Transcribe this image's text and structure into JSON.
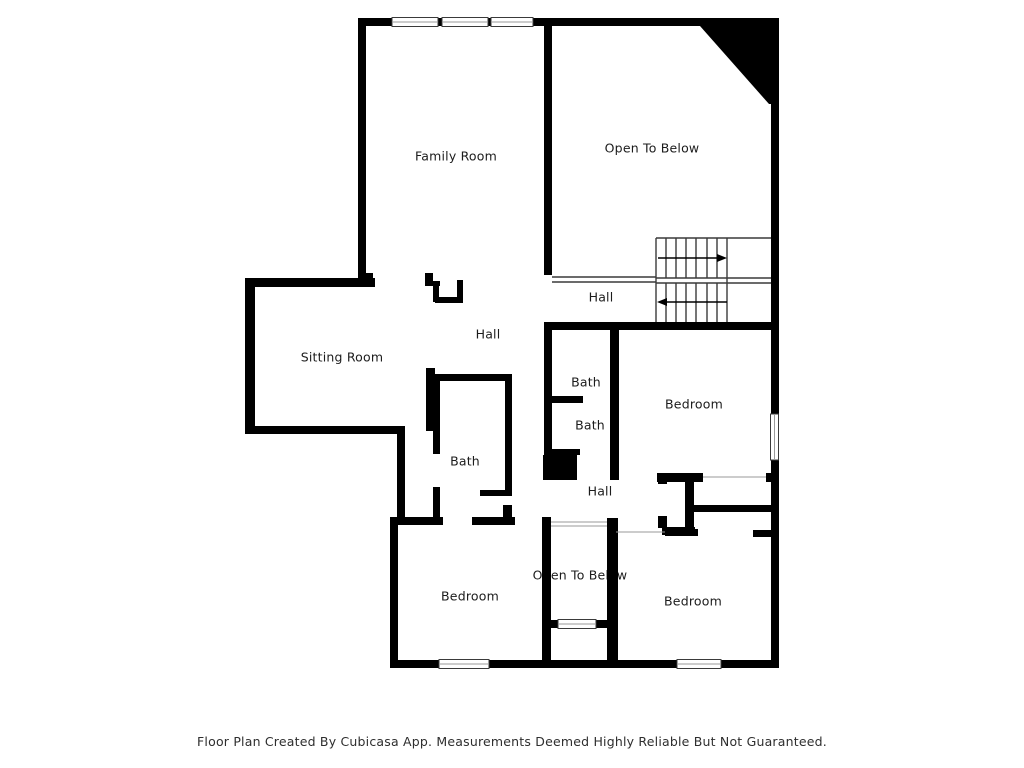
{
  "title": "Second Floor Plan",
  "rooms": {
    "family_room": "Family Room",
    "open_below_top": "Open To Below",
    "hall_upper": "Hall",
    "hall_center": "Hall",
    "sitting_room": "Sitting Room",
    "bath_top": "Bath",
    "bath_mid": "Bath",
    "bedroom_top_right": "Bedroom",
    "bath_center": "Bath",
    "hall_lower": "Hall",
    "bedroom_bottom_left": "Bedroom",
    "open_below_bottom": "Open To Below",
    "bedroom_bottom_right": "Bedroom"
  },
  "footer": {
    "disclaimer": "Floor Plan Created By Cubicasa App. Measurements Deemed Highly Reliable But Not Guaranteed."
  },
  "colors": {
    "wall": "#000000",
    "background": "#ffffff",
    "stair_line": "#3a3a3a"
  }
}
